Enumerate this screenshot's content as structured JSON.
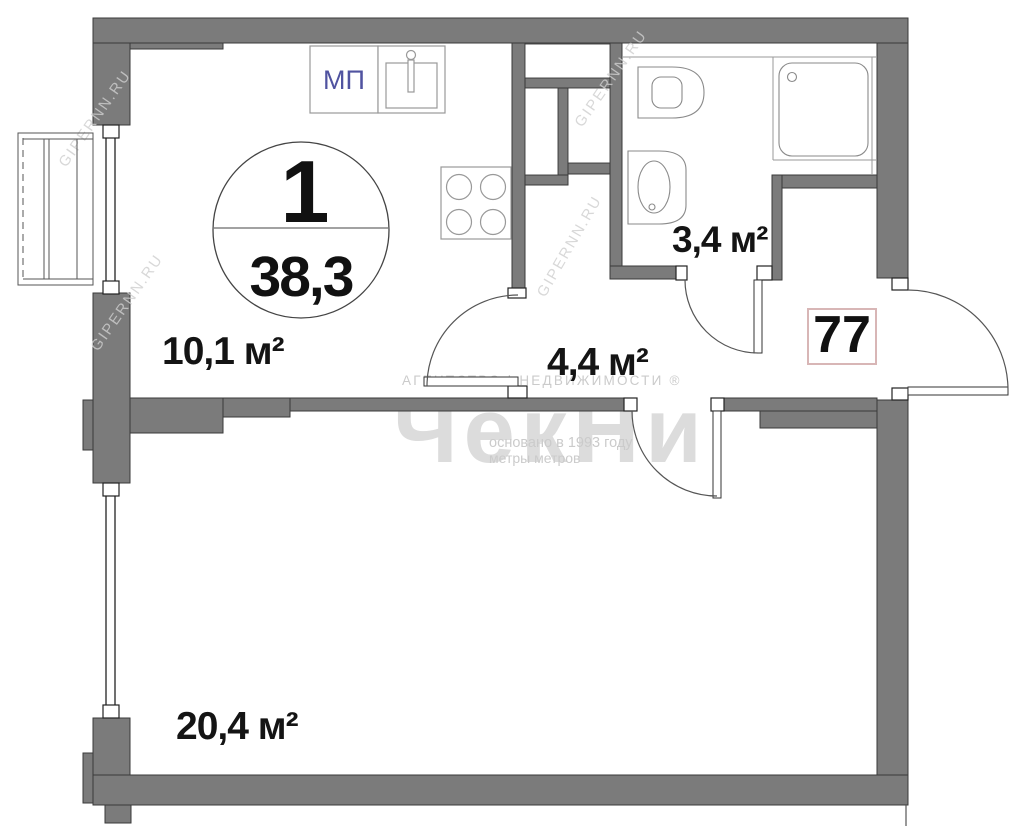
{
  "plan": {
    "unit_circle": {
      "room_count": "1",
      "total_area": "38,3"
    },
    "rooms": {
      "kitchen": "10,1 м²",
      "bathroom": "3,4 м²",
      "hallway": "4,4 м²",
      "living_room": "20,4 м²"
    },
    "apartment_number": "77",
    "window_type_mark": "МП"
  },
  "watermarks": {
    "agency_line": "АГЕНТСТВО | НЕДВИЖИМОСТИ ®",
    "brand": "ЧекНи",
    "founded_line": "основано в 1993 году",
    "slogan_line": "метры метров",
    "portal": "GIPERNN.RU"
  },
  "colors": {
    "wall_fill": "#7b7b7b",
    "wall_outline": "#3a3a3a",
    "window_mark_text": "#5053a0",
    "apartment_number_border": "#d8b6b6",
    "label_text": "#141414",
    "watermark_gray": "#cbcbcb"
  }
}
